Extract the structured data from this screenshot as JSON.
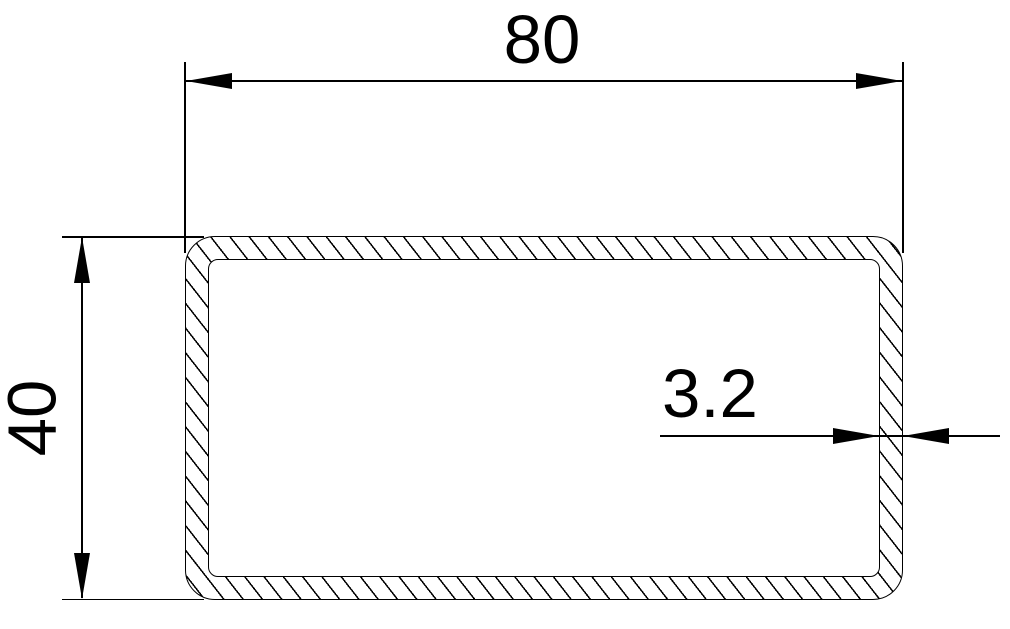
{
  "drawing": {
    "description": "Cross-section of a rectangular hollow steel tube with section hatching",
    "background_color": "#ffffff",
    "line_color": "#000000",
    "labels": {
      "width": "80",
      "height": "40",
      "thickness": "3.2"
    }
  }
}
